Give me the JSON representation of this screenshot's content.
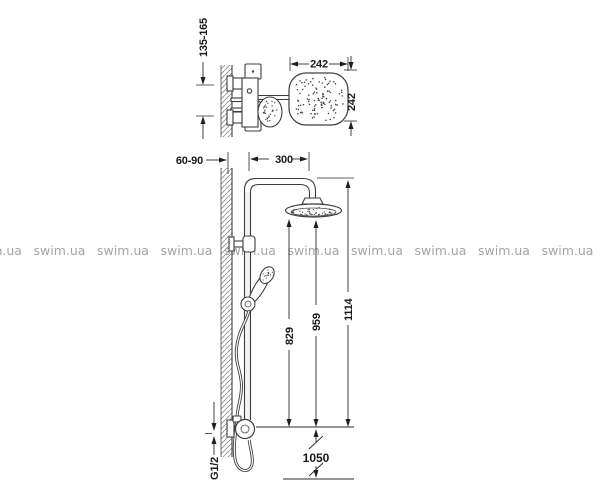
{
  "drawing": {
    "top_view": {
      "mount_spacing": "135-165",
      "head_width": "242",
      "head_depth": "242"
    },
    "side_view": {
      "wall_distance": "60-90",
      "arm_reach": "300",
      "handshower_height": "829",
      "head_clearance": "959",
      "total_height": "1114",
      "supply_rise": "1050",
      "thread_size": "G1/2"
    }
  },
  "watermark": {
    "text": "swim.ua",
    "color": "#9a9a9a"
  },
  "colors": {
    "line": "#3d3d3d",
    "text": "#1a1a1a",
    "background": "#ffffff"
  }
}
